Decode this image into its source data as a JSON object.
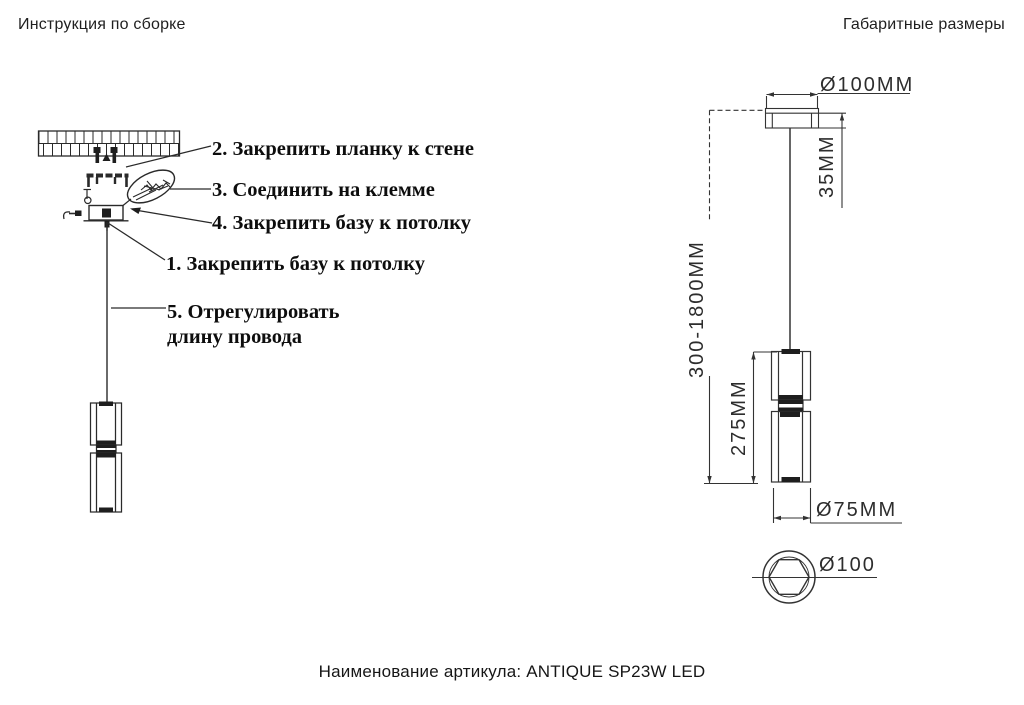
{
  "assembly": {
    "title": "Инструкция по сборке",
    "steps": [
      {
        "text": "2. Закрепить планку к стене"
      },
      {
        "text": "3. Соединить на клемме"
      },
      {
        "text": "4. Закрепить базу к потолку"
      },
      {
        "text": "1. Закрепить базу к потолку"
      },
      {
        "text": "5. Отрегулировать",
        "text2": "длину провода"
      }
    ]
  },
  "dimensions": {
    "title": "Габаритные размеры",
    "canopy_diameter": "Ø100MM",
    "canopy_height": "35MM",
    "suspension_length": "300-1800MM",
    "body_height": "275MM",
    "shade_diameter": "Ø75MM",
    "base_bottom_diameter": "Ø100"
  },
  "footer": {
    "caption": "Наименование артикула: ANTIQUE SP23W LED"
  },
  "colors": {
    "background": "#ffffff",
    "line": "#2a2a2a",
    "text": "#1c1c1c"
  }
}
